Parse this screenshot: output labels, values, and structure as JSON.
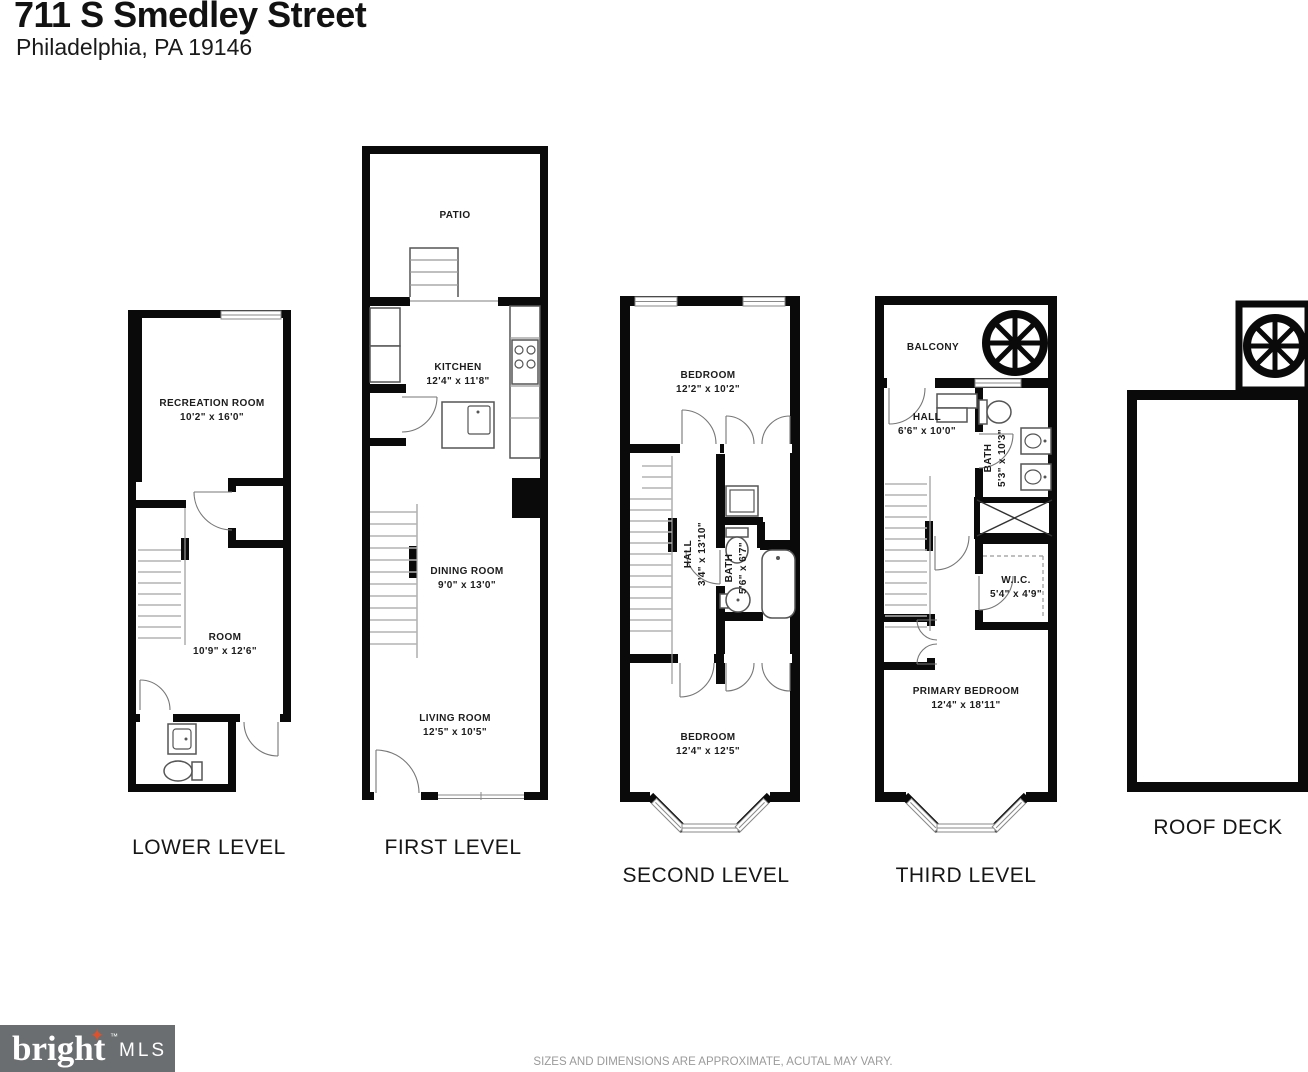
{
  "header": {
    "address": "711 S Smedley Street",
    "city": "Philadelphia, PA 19146"
  },
  "levels": {
    "lower": {
      "label": "LOWER LEVEL",
      "rooms": {
        "recreation": {
          "name": "RECREATION ROOM",
          "dims": "10'2\" x 16'0\""
        },
        "room": {
          "name": "ROOM",
          "dims": "10'9\" x 12'6\""
        }
      }
    },
    "first": {
      "label": "FIRST LEVEL",
      "rooms": {
        "patio": {
          "name": "PATIO"
        },
        "kitchen": {
          "name": "KITCHEN",
          "dims": "12'4\" x 11'8\""
        },
        "dining": {
          "name": "DINING ROOM",
          "dims": "9'0\" x 13'0\""
        },
        "living": {
          "name": "LIVING ROOM",
          "dims": "12'5\" x 10'5\""
        }
      }
    },
    "second": {
      "label": "SECOND LEVEL",
      "rooms": {
        "bedroom_top": {
          "name": "BEDROOM",
          "dims": "12'2\" x 10'2\""
        },
        "hall": {
          "name": "HALL",
          "dims": "3'4\" x 13'10\""
        },
        "bath": {
          "name": "BATH",
          "dims": "5'6\" x 6'7\""
        },
        "bedroom_bottom": {
          "name": "BEDROOM",
          "dims": "12'4\" x 12'5\""
        }
      }
    },
    "third": {
      "label": "THIRD LEVEL",
      "rooms": {
        "balcony": {
          "name": "BALCONY"
        },
        "hall": {
          "name": "HALL",
          "dims": "6'6\" x 10'0\""
        },
        "bath": {
          "name": "BATH",
          "dims": "5'3\" x 10'3\""
        },
        "wic": {
          "name": "W.I.C.",
          "dims": "5'4\" x 4'9\""
        },
        "primary": {
          "name": "PRIMARY BEDROOM",
          "dims": "12'4\" x 18'11\""
        }
      }
    },
    "roof": {
      "label": "ROOF DECK"
    }
  },
  "footer": {
    "logo_main": "bright",
    "logo_tm": "™",
    "logo_mls": "MLS",
    "disclaimer": "SIZES AND DIMENSIONS ARE APPROXIMATE, ACUTAL MAY VARY."
  },
  "colors": {
    "wall": "#0a0a0a",
    "logo_bg": "#6b6e70",
    "logo_star": "#e0512b",
    "disclaimer_text": "#9a9a9a"
  }
}
